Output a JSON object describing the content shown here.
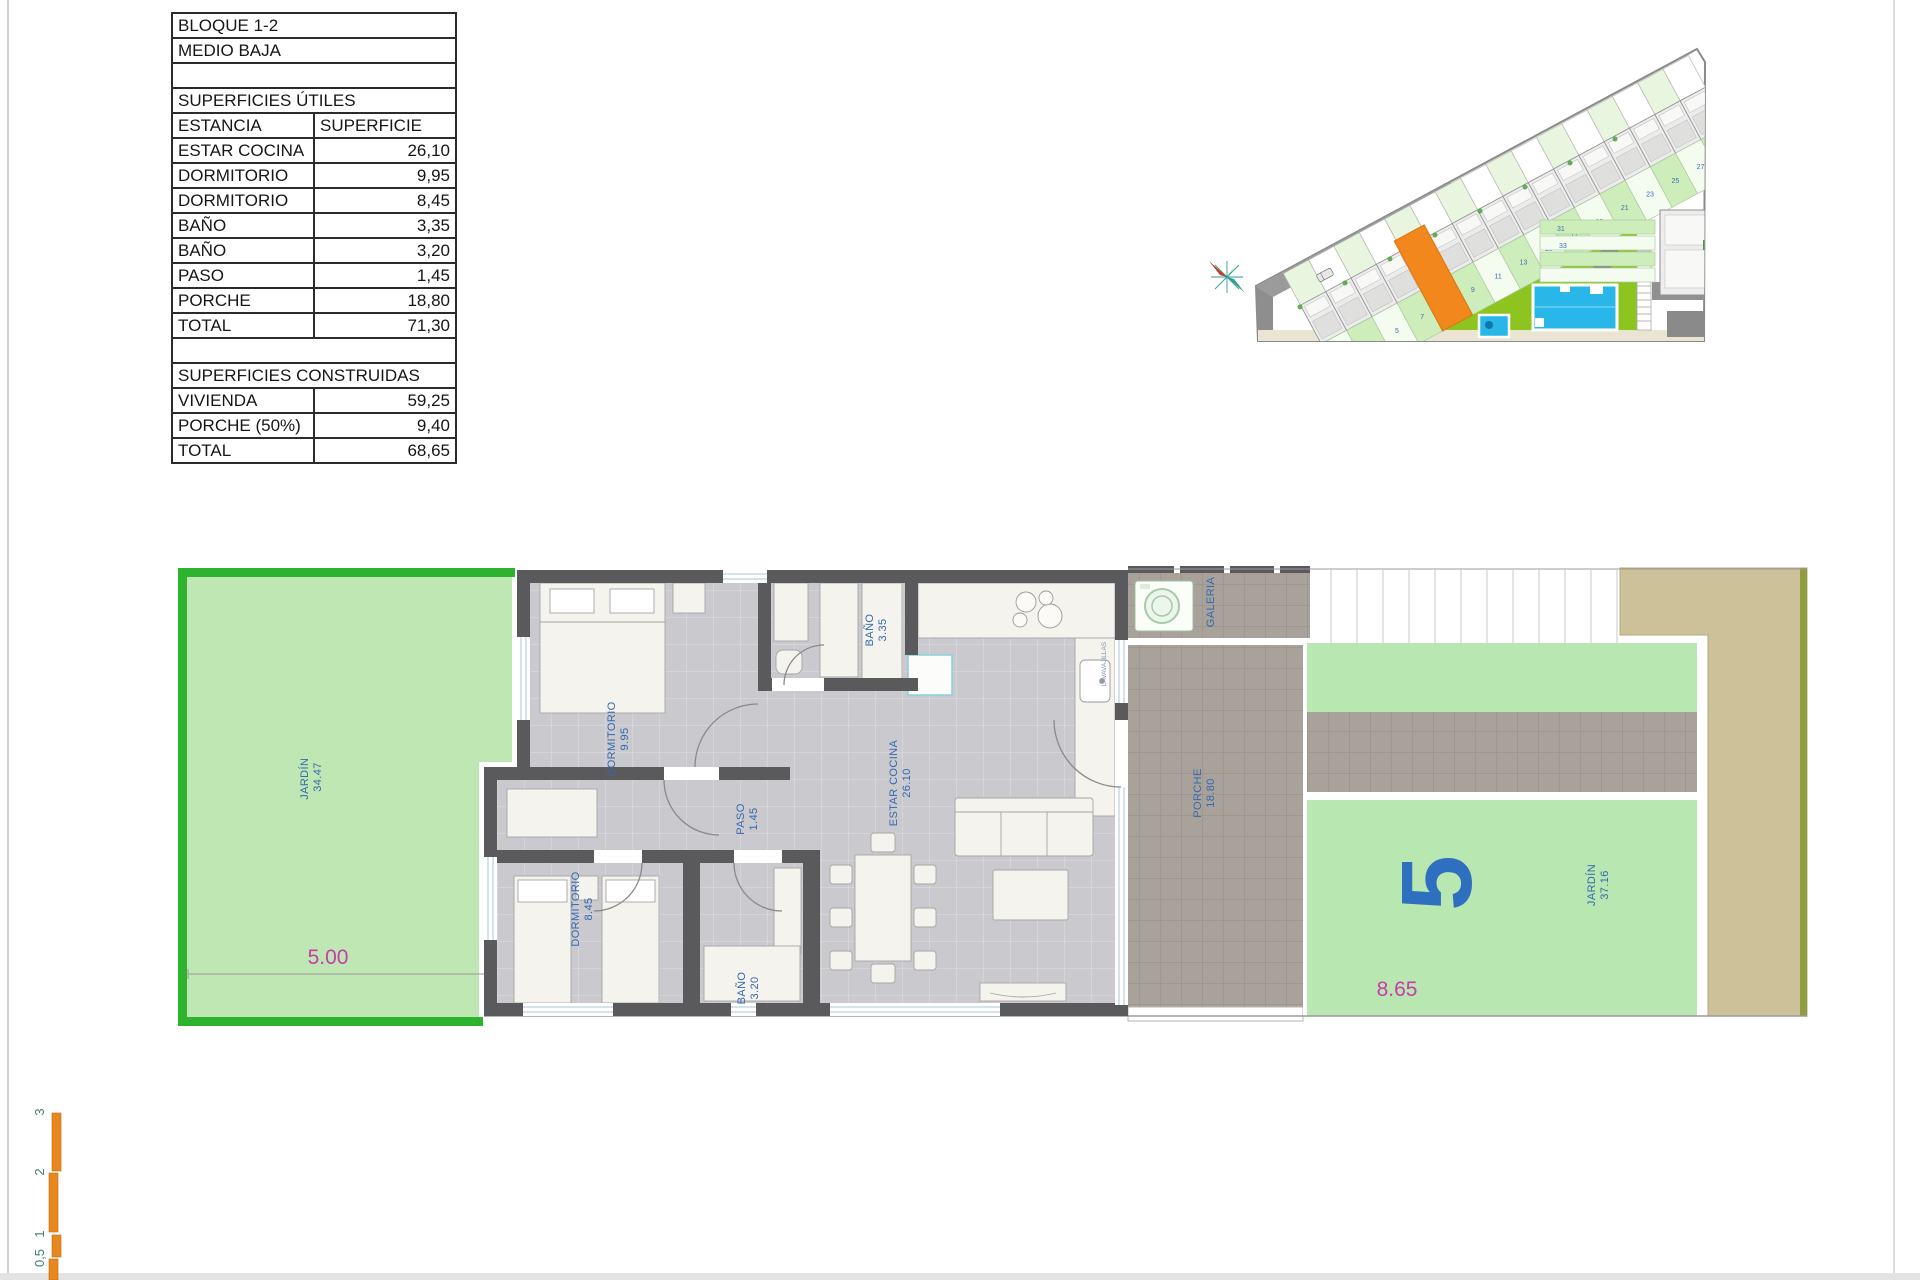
{
  "table": {
    "header1": "BLOQUE 1-2",
    "header2": "MEDIO BAJA",
    "section1_title": "SUPERFICIES ÚTILES",
    "col1": "ESTANCIA",
    "col2": "SUPERFICIE",
    "utiles": [
      [
        "ESTAR COCINA",
        "26,10"
      ],
      [
        "DORMITORIO",
        "9,95"
      ],
      [
        "DORMITORIO",
        "8,45"
      ],
      [
        "BAÑO",
        "3,35"
      ],
      [
        "BAÑO",
        "3,20"
      ],
      [
        "PASO",
        "1,45"
      ],
      [
        "PORCHE",
        "18,80"
      ],
      [
        "TOTAL",
        "71,30"
      ]
    ],
    "section2_title": "SUPERFICIES CONSTRUIDAS",
    "construidas": [
      [
        "VIVIENDA",
        "59,25"
      ],
      [
        "PORCHE (50%)",
        "9,40"
      ],
      [
        "TOTAL",
        "68,65"
      ]
    ]
  },
  "floor_plan": {
    "jardin_left": {
      "label": "JARDÍN",
      "area": "34.47"
    },
    "dorm1": {
      "label": "DORMITORIO",
      "area": "9.95"
    },
    "dorm2": {
      "label": "DORMITORIO",
      "area": "8.45"
    },
    "bano1": {
      "label": "BAÑO",
      "area": "3.35"
    },
    "bano2": {
      "label": "BAÑO",
      "area": "3.20"
    },
    "paso": {
      "label": "PASO",
      "area": "1.45"
    },
    "estar": {
      "label": "ESTAR COCINA",
      "area": "26.10"
    },
    "galeria": {
      "label": "GALERIA"
    },
    "porche": {
      "label": "PORCHE",
      "area": "18.80"
    },
    "jardin_right": {
      "label": "JARDÍN",
      "area": "37.16"
    },
    "unit_number": "5",
    "dim_front": "5.00",
    "dim_back": "8.65",
    "appliance": "LAVAVAJILLAS"
  },
  "site_plan": {
    "plot_numbers": [
      "3",
      "5",
      "7",
      "9",
      "11",
      "13",
      "15",
      "17",
      "19",
      "21",
      "23",
      "25",
      "27",
      "29"
    ],
    "block_numbers": [
      "31",
      "33"
    ]
  },
  "scale_bar": {
    "ticks": [
      "3",
      "2",
      "1",
      "0,5"
    ]
  },
  "colors": {
    "label_blue": "#3468af",
    "dimension_magenta": "#c83cab",
    "garden_border_green": "#2eb32e",
    "garden_fill": "#bfe7b4",
    "lawn_green": "#8dc41f",
    "pool_blue": "#28b7e8",
    "highlight_orange": "#f2871e",
    "wall_gray": "#5a5a5c",
    "floor_gray": "#c9c9ce",
    "tile_taupe": "#a8a199",
    "path_tan": "#cdc199",
    "scale_orange": "#e8871e"
  }
}
